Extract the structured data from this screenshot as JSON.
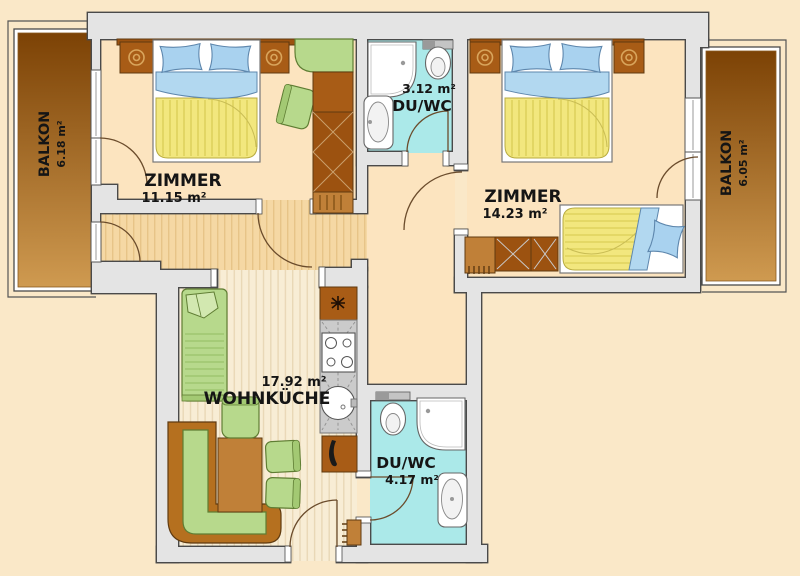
{
  "title": "Apartment floor plan",
  "labels": {
    "balcony_left": {
      "name": "BALKON",
      "area": "6.18 m²"
    },
    "bedroom_left": {
      "name": "ZIMMER",
      "area": "11.15 m²"
    },
    "bath_top": {
      "name": "DU/WC",
      "area": "3.12 m²"
    },
    "bedroom_right": {
      "name": "ZIMMER",
      "area": "14.23 m²"
    },
    "balcony_right": {
      "name": "BALKON",
      "area": "6.05 m²"
    },
    "living_kitchen": {
      "name": "WOHNKÜCHE",
      "area": "17.92 m²"
    },
    "bath_bottom": {
      "name": "DU/WC",
      "area": "4.17 m²"
    }
  },
  "colors": {
    "bg": "#fae8c8",
    "wall-fill": "#e4e4e4",
    "wall-line": "#4a4a4a",
    "floor-room": "#fce4bf",
    "floor-bath": "#abe9e9",
    "hall-base": "#f5d8a4",
    "hall-line": "#e7c488",
    "living-base": "#f8edd5",
    "living-line": "#e9d8b6",
    "balcony-dark": "#7c4205",
    "balcony-light": "#cf9a50",
    "wood-dark": "#9c5210",
    "wood-mid": "#a85c16",
    "wood-light": "#c08038",
    "wood-line": "#5f3a10",
    "green-seat": "#b7d98c",
    "green-light": "#a3c973",
    "green-line": "#5f7d33",
    "blue-pillow": "#a9d2ef",
    "blue-fold": "#b2d8f0",
    "blue-line": "#5e87ad",
    "yellow-blanket": "#f2e77e",
    "yellow-line": "#d5c84f",
    "white": "#ffffff",
    "fixture-line": "#666666",
    "counter": "#cbcbcb",
    "door-line": "#6b4c2c",
    "text": "#151515"
  }
}
